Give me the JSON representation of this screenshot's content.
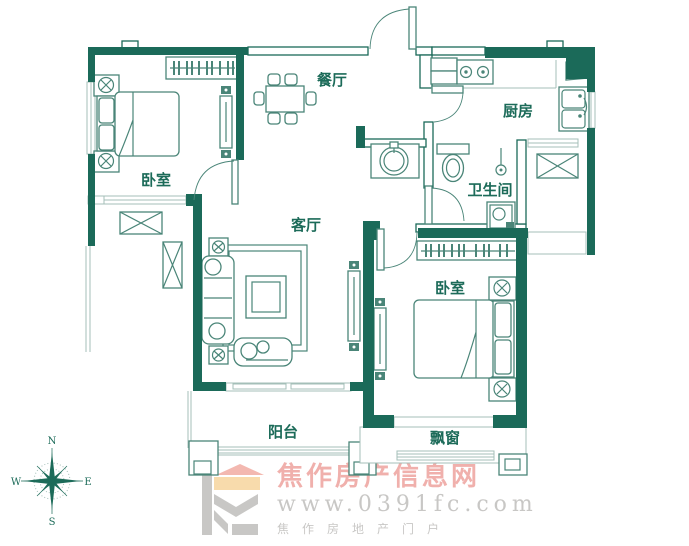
{
  "rooms": {
    "bedroom1": "卧室",
    "dining": "餐厅",
    "kitchen": "厨房",
    "bathroom": "卫生间",
    "living": "客厅",
    "bedroom2": "卧室",
    "balcony": "阳台",
    "bay_window": "飘窗"
  },
  "compass": {
    "n": "N",
    "s": "S",
    "e": "E",
    "w": "W"
  },
  "watermark": {
    "site_name": "焦作房产信息网",
    "site_url": "www.0391fc.com",
    "tagline": "焦作房地产门户"
  },
  "colors": {
    "wall": "#1b6a59",
    "line": "#4a8578",
    "light_line": "#a4bfb8",
    "label_text": "#1c6b59",
    "watermark_pink": "#efaaa6",
    "watermark_gray": "#c4c3c1",
    "logo_roof": "#f3b3aa",
    "logo_band": "#f8d8a6"
  }
}
